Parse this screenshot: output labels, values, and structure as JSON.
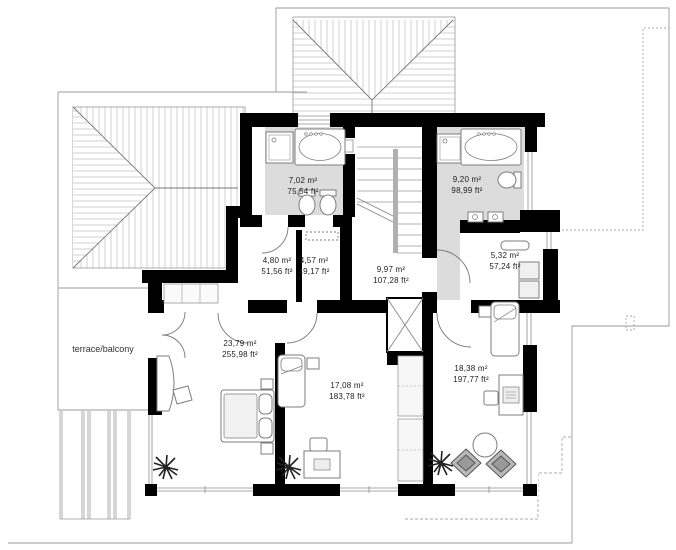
{
  "plan": {
    "drawing_type": "upper floor plan",
    "terrace": {
      "label": "terrace/balcony"
    },
    "rooms": {
      "bathroom1": {
        "m2": "7,02 m²",
        "ft2": "75,54 ft²"
      },
      "bathroom2": {
        "m2": "9,20 m²",
        "ft2": "98,99 ft²"
      },
      "room480": {
        "m2": "4,80 m²",
        "ft2": "51,56 ft²"
      },
      "room457": {
        "m2": "4,57 m²",
        "ft2": "49,17 ft²"
      },
      "hall": {
        "m2": "9,97 m²",
        "ft2": "107,28 ft²"
      },
      "room532": {
        "m2": "5,32 m²",
        "ft2": "57,24 ft²"
      },
      "bedroom2379": {
        "m2": "23,79 m²",
        "ft2": "255,98 ft²"
      },
      "bedroom1708": {
        "m2": "17,08 m²",
        "ft2": "183,78 ft²"
      },
      "bedroom1838": {
        "m2": "18,38 m²",
        "ft2": "197,77 ft²"
      }
    },
    "colors": {
      "wall": "#000000",
      "bath_floor": "#dcdcdc",
      "roof_hatch": "#c6c6c6",
      "outline": "#999999",
      "pouf": "#b9b9b9"
    }
  }
}
